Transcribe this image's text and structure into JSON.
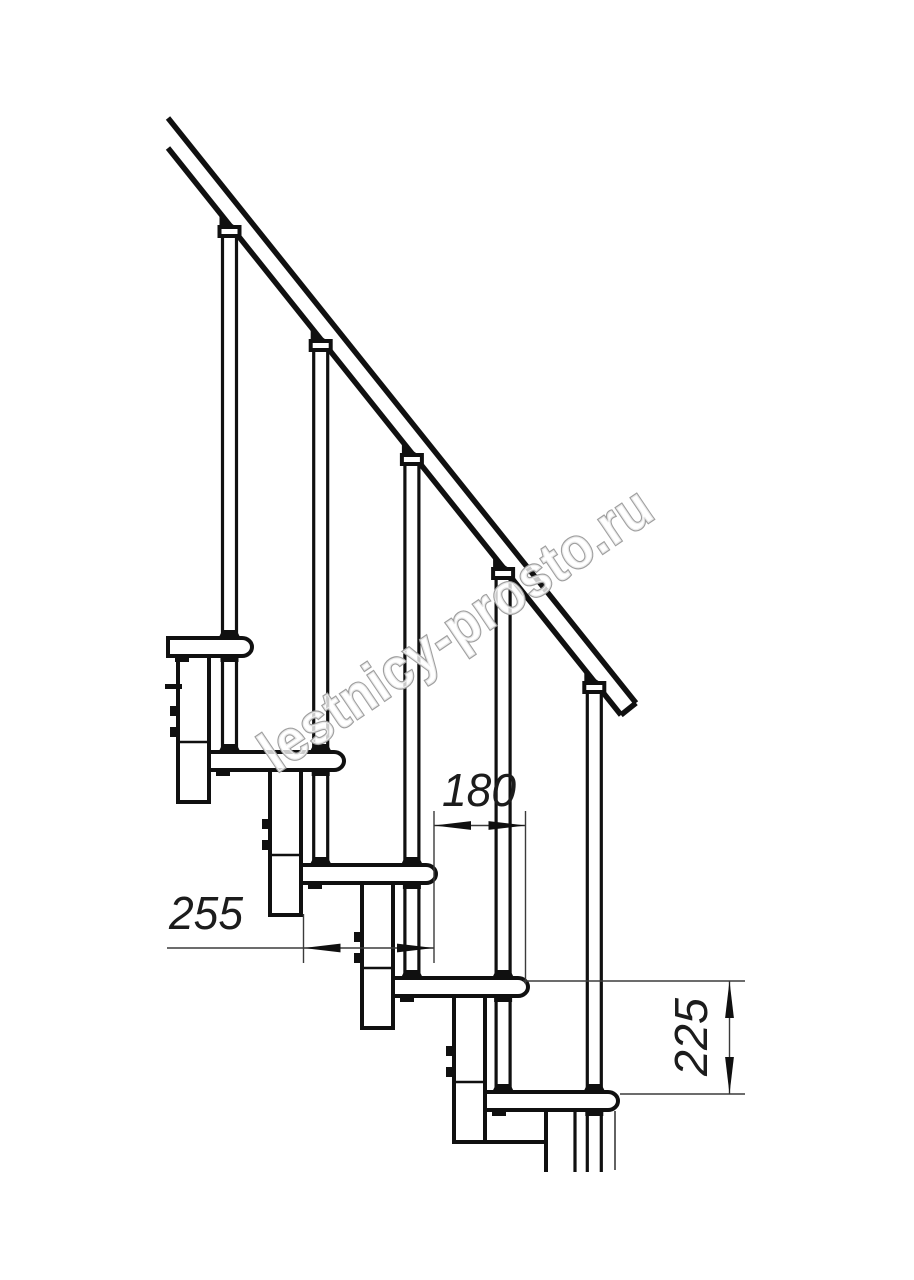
{
  "drawing": {
    "kind": "staircase side elevation technical drawing",
    "watermark": "lestnicy-prosto.ru",
    "dimensions": [
      {
        "value": "180",
        "orientation": "horizontal"
      },
      {
        "value": "255",
        "orientation": "horizontal"
      },
      {
        "value": "225",
        "orientation": "vertical"
      }
    ],
    "colors": {
      "line": "#101010",
      "thin_line": "#3b3b3b",
      "watermark_outline": "#9f9f9f",
      "background": "#ffffff"
    }
  }
}
